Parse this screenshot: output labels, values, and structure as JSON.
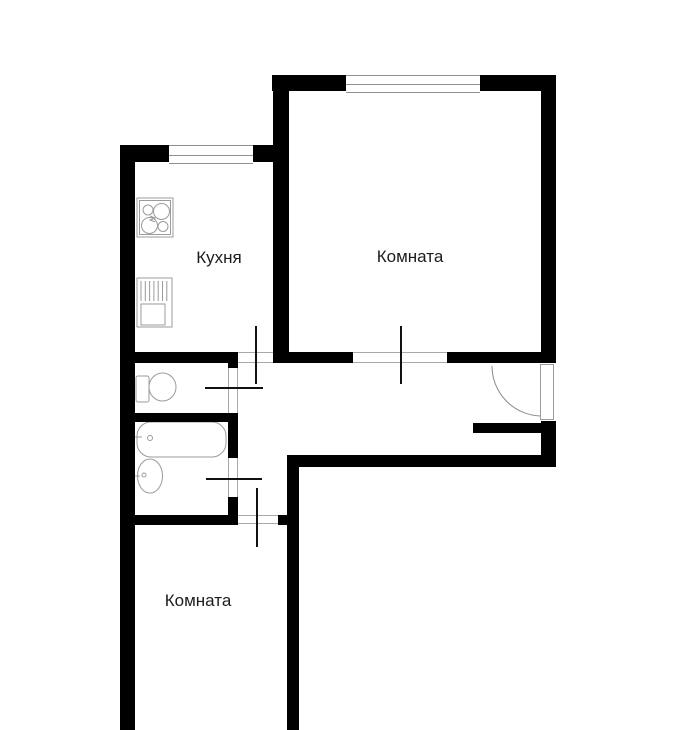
{
  "plan": {
    "type": "apartment-floor-plan",
    "labels": {
      "kitchen": "Кухня",
      "room_top": "Комната",
      "room_bottom": "Комната"
    },
    "colors": {
      "background": "#ffffff",
      "walls": "#000000",
      "fixture_lines": "#9b9b9b",
      "door_leaf": "#111111"
    },
    "icons": {
      "stove": "stove-icon",
      "kitchen_sink": "kitchen-sink-icon",
      "toilet": "toilet-icon",
      "bathtub": "bathtub-icon",
      "washbasin": "washbasin-icon",
      "entrance_door": "entrance-door-arc-icon",
      "window": "window-icon"
    }
  }
}
